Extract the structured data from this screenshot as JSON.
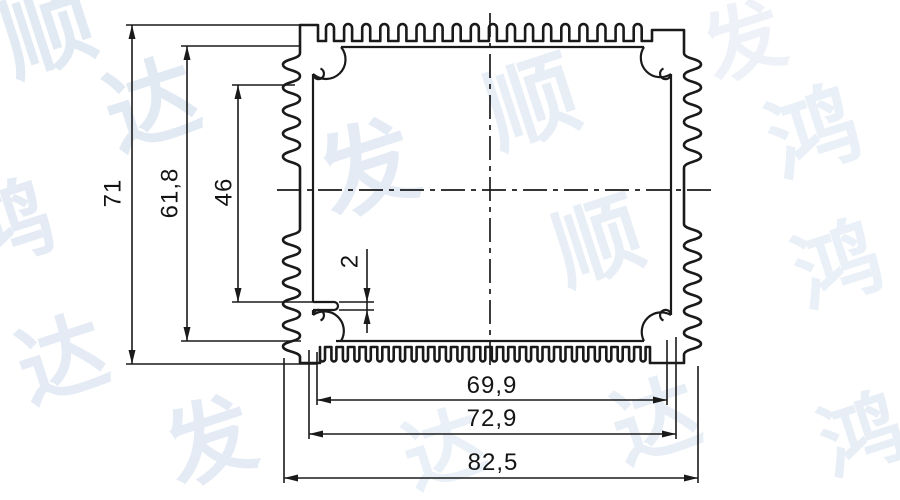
{
  "drawing": {
    "background": "#ffffff",
    "line_color": "#1a1a1a"
  },
  "watermark": {
    "text": "鸿发顺达",
    "color": "#d9e3f0"
  },
  "dimensions": {
    "overall_height": {
      "label": "71",
      "value": 71
    },
    "inner_height": {
      "label": "61,8",
      "value": 61.8
    },
    "cavity_height": {
      "label": "46",
      "value": 46
    },
    "ledge_thickness": {
      "label": "2",
      "value": 2
    },
    "inner_width": {
      "label": "69,9",
      "value": 69.9
    },
    "body_width": {
      "label": "72,9",
      "value": 72.9
    },
    "overall_width": {
      "label": "82,5",
      "value": 82.5
    }
  },
  "profile": {
    "top_fin_count": 18,
    "bottom_fin_count": 29,
    "left_fin_bands": 2,
    "right_fin_bands": 2,
    "screw_boss_count": 4
  }
}
